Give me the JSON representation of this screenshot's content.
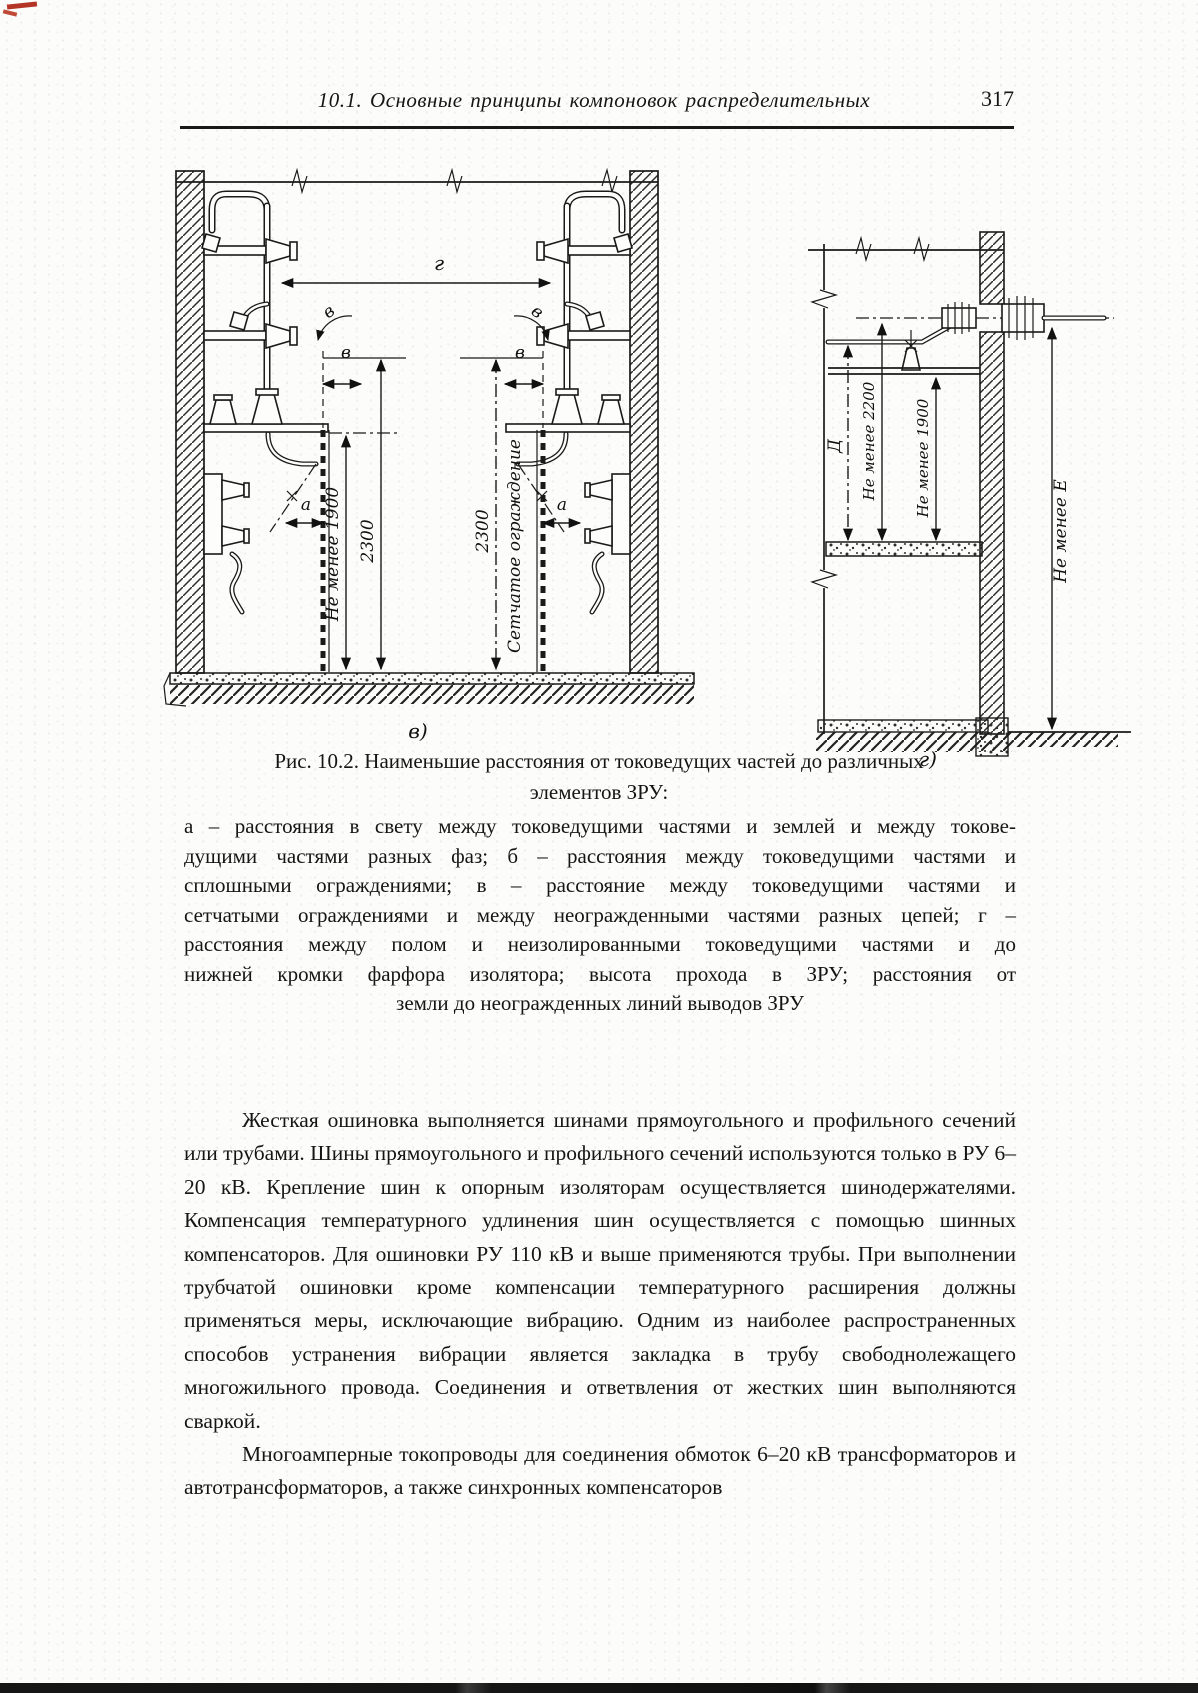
{
  "header": {
    "title": "10.1.  Основные  принципы  компоновок  распределительных",
    "page_number": "317"
  },
  "figure": {
    "caption": {
      "line1": "Рис. 10.2. Наименьшие  расстояния от токоведущих  частей  до  различных",
      "line2": "элементов ЗРУ:"
    },
    "legend_lines": [
      "а – расстояния в свету между токоведущими частями и землей и между токове-",
      "дущими частями разных фаз; б – расстояния между токоведущими частями и",
      "сплошными ограждениями; в – расстояние между токоведущими частями и",
      "сетчатыми ограждениями и между неогражденными частями разных цепей; г –",
      "расстояния между полом и неизолированными токоведущими частями и до",
      "нижней кромки фарфора изолятора; высота прохода в ЗРУ; расстояния от",
      "земли до неогражденных линий выводов ЗРУ"
    ],
    "diagram_labels": {
      "gap": "г",
      "v": "в",
      "a": "а",
      "min_1900": "Не менее 1900",
      "h_2300": "2300",
      "mesh_fence": "Сетчатое ограждение",
      "sub_left": "в)",
      "sub_right": "г)",
      "d": "Д",
      "min_2200": "Не менее 2200",
      "min_e": "Не менее Е"
    }
  },
  "body": {
    "paragraphs": [
      "Жесткая ошиновка выполняется шинами прямоугольного и профильного сечений или трубами. Шины прямоугольного и профильного сечений используются только в РУ 6–20 кВ. Крепление шин к опорным изоляторам осуществляется шинодержателями. Компенсация температурного удлинения шин осуществляется с помощью шинных компенсаторов. Для ошиновки РУ 110 кВ и выше применяются трубы. При выполнении трубчатой ошиновки кроме компенсации температурного расширения должны применяться меры, исключающие вибрацию. Одним из наиболее распространенных способов устранения вибрации является закладка в трубу свободнолежащего многожильного провода. Соединения и ответвления от жестких шин выполняются сваркой.",
      "Многоамперные токопроводы для соединения обмоток 6–20 кВ трансформаторов и автотрансформаторов, а также синхронных компенсаторов"
    ]
  },
  "colors": {
    "paper": "#fcfcfa",
    "ink": "#1a1a1a",
    "red_mark": "#b43527"
  }
}
